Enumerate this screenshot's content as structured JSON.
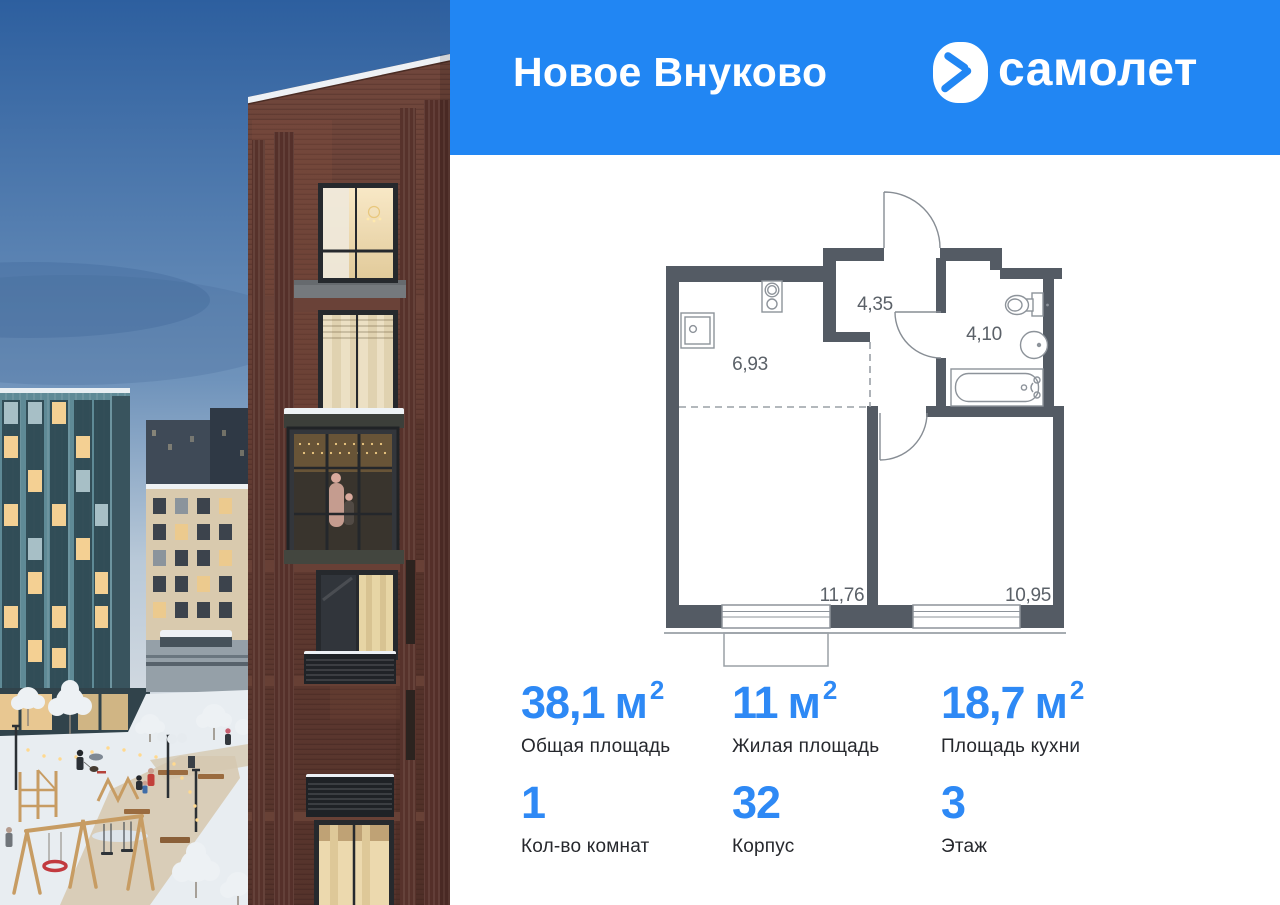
{
  "header": {
    "title": "Новое Вну­ково",
    "brand_name": "самолет"
  },
  "floor_plan": {
    "rooms": [
      {
        "id": "kitchen",
        "area_label": "6,93"
      },
      {
        "id": "hallway",
        "area_label": "4,35"
      },
      {
        "id": "bathroom",
        "area_label": "4,10"
      },
      {
        "id": "living-room",
        "area_label": "11,76"
      },
      {
        "id": "bedroom",
        "area_label": "10,95"
      }
    ]
  },
  "stats": {
    "total_area": {
      "value": "38,1",
      "unit": "м",
      "sup": "2",
      "label": "Общая площадь"
    },
    "living_area": {
      "value": "11",
      "unit": "м",
      "sup": "2",
      "label": "Жилая площадь"
    },
    "kitchen_area": {
      "value": "18,7",
      "unit": "м",
      "sup": "2",
      "label": "Площадь кухни"
    },
    "rooms_count": {
      "value": "1",
      "label": "Кол-во комнат"
    },
    "building": {
      "value": "32",
      "label": "Корпус"
    },
    "floor": {
      "value": "3",
      "label": "Этаж"
    }
  },
  "colors": {
    "brand_blue": "#2186f3",
    "number_blue": "#2e89f5",
    "wall_dark": "#545b64",
    "plan_line_gray": "#9aa0a6",
    "label_dark": "#26282d"
  }
}
